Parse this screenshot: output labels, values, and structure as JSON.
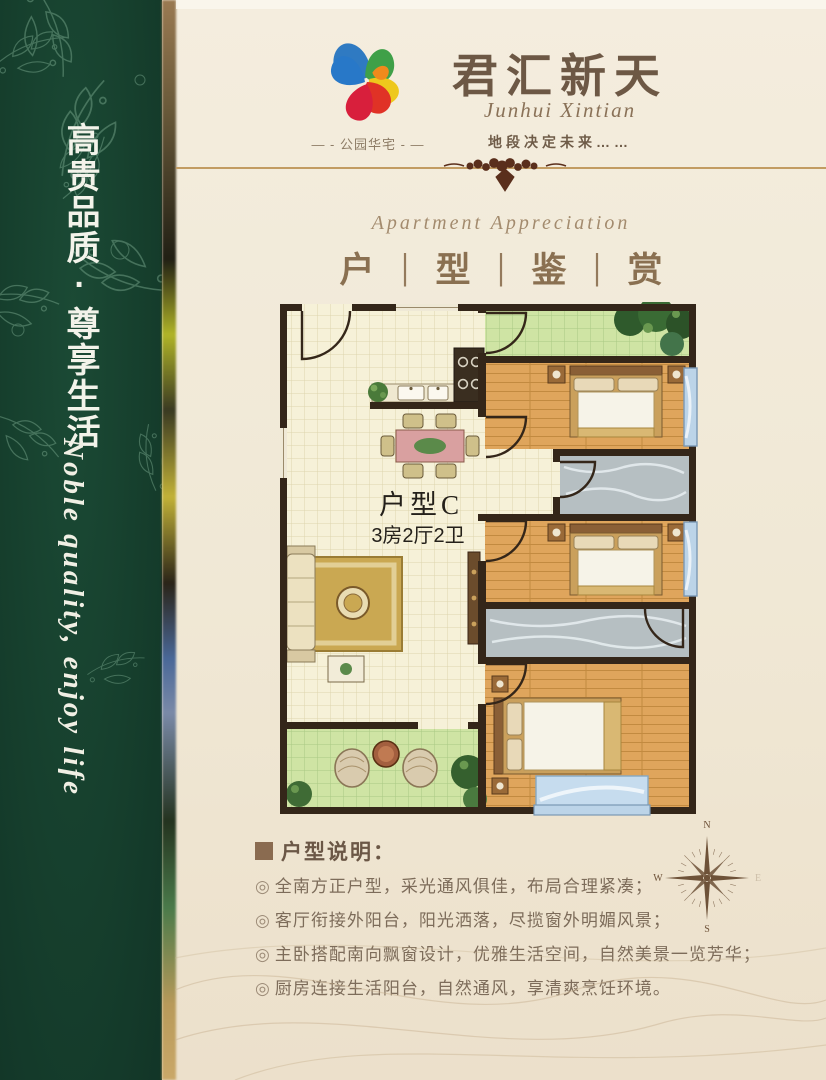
{
  "sidebar": {
    "slogan_cn": "高贵品质·尊享生活",
    "slogan_en": "Noble quality, enjoy life"
  },
  "header": {
    "logo_label": "— - 公园华宅 - —",
    "title": "君汇新天",
    "subtitle": "Junhui Xintian",
    "tagline": "地段决定未来……"
  },
  "section": {
    "title_en": "Apartment Appreciation",
    "title_chars": [
      "户",
      "型",
      "鉴",
      "赏"
    ],
    "separator": "|"
  },
  "floorplan": {
    "unit_label": "户型C",
    "unit_spec": "3房2厅2卫"
  },
  "description": {
    "heading": "户型说明：",
    "bullet_glyph": "◎",
    "items": [
      "全南方正户型，采光通风俱佳，布局合理紧凑；",
      "客厅衔接外阳台，阳光洒落，尽揽窗外明媚风景；",
      "主卧搭配南向飘窗设计，优雅生活空间，自然美景一览芳华；",
      "厨房连接生活阳台，自然通风，享清爽烹饪环境。"
    ]
  },
  "compass": {
    "north": "N",
    "west": "W",
    "south": "S",
    "east": "E"
  },
  "colors": {
    "sidebar_green": "#16432f",
    "background_cream": "#f0e8d5",
    "title_brown": "#6d5845",
    "divider_gold": "#c29c62",
    "wall_dark": "#342619",
    "wood_floor": "#dfa55c",
    "bathroom_marble": "#b6bfc2",
    "balcony_green": "#cfe4a4",
    "bay_window_blue": "#bcd4e8"
  }
}
